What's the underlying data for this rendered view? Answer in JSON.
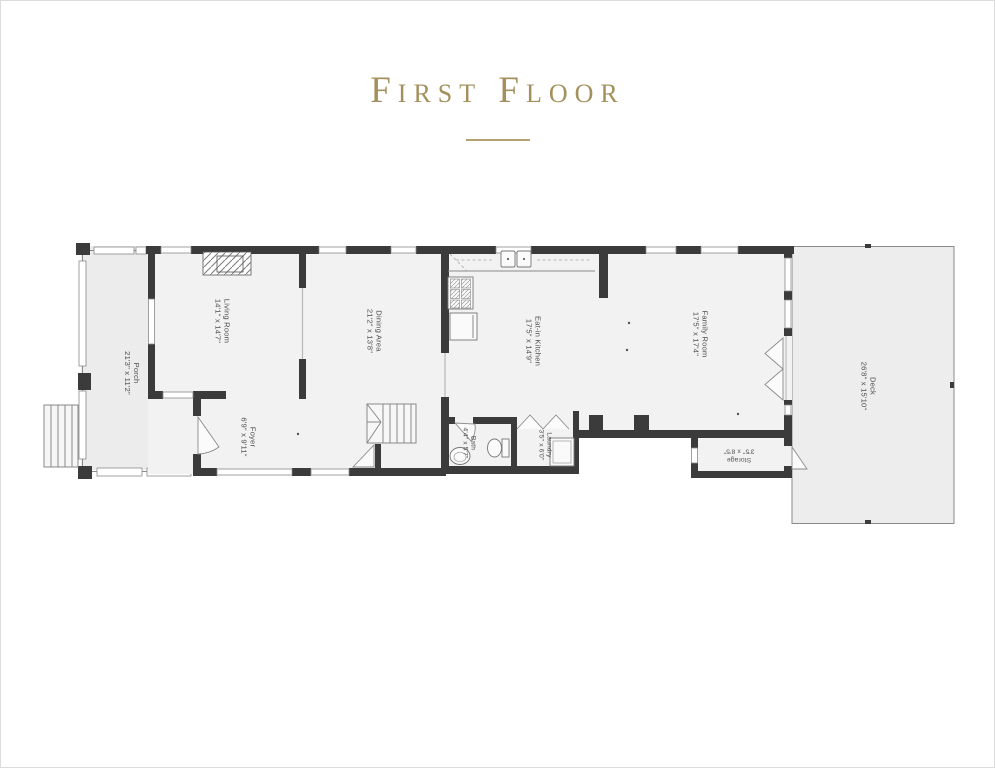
{
  "title": "First Floor",
  "rooms": [
    {
      "label": "Porch",
      "dimensions": "21'3\" x 11'2\""
    },
    {
      "label": "Living Room",
      "dimensions": "14'1\" x 14'7\""
    },
    {
      "label": "Foyer",
      "dimensions": "6'9\" x 9'11\""
    },
    {
      "label": "Dining Area",
      "dimensions": "21'2\" x 13'8\""
    },
    {
      "label": "Eat-in Kitchen",
      "dimensions": "17'5\" x 14'9\""
    },
    {
      "label": "Family Room",
      "dimensions": "17'5\" x 17'4\""
    },
    {
      "label": "Bath",
      "dimensions": "4'4\" x 5'7\""
    },
    {
      "label": "Laundry",
      "dimensions": "3'5\" x 6'0\""
    },
    {
      "label": "Storage",
      "dimensions": "3'5\" x 8'5\""
    },
    {
      "label": "Deck",
      "dimensions": "26'8\" x 15'10\""
    }
  ],
  "colors": {
    "accent_gold": "#a3905c",
    "wall": "#3b3b3b",
    "interior_fill": "#f2f2f2",
    "outdoor_fill": "#ececec"
  }
}
